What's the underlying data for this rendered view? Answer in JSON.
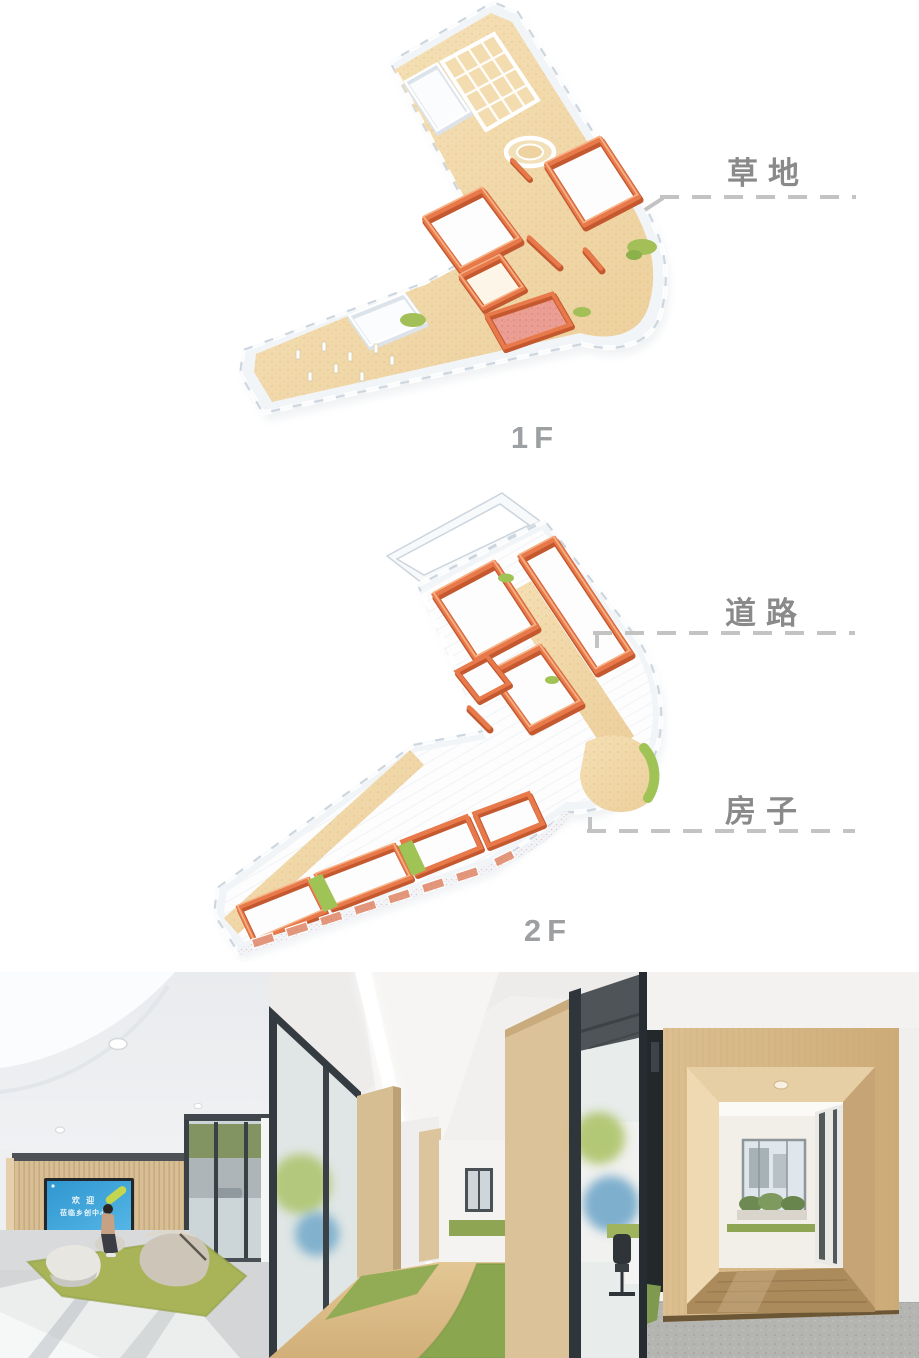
{
  "page": {
    "bg": "#ffffff"
  },
  "diagram": {
    "callouts": [
      {
        "label": "草地"
      },
      {
        "label": "道路"
      },
      {
        "label": "房子"
      }
    ],
    "floor_labels": [
      {
        "label": "1F"
      },
      {
        "label": "2F"
      }
    ],
    "label_color": "#8a8a8a",
    "dash_color": "#c3c3c3",
    "palette": {
      "wall_orange": "#e8794a",
      "wall_orange_dark": "#c4582f",
      "wall_orange_light": "#f6b285",
      "floor_sand": "#f0d7a6",
      "grass_green": "#a2c057",
      "outer_wall_white": "#f2f5f8"
    }
  },
  "photos": [
    {
      "name": "lobby-reception",
      "screen": {
        "line1": "欢 迎",
        "line2": "莅临乡创中心"
      }
    },
    {
      "name": "office-corridor"
    },
    {
      "name": "wood-portal-corridor"
    }
  ]
}
